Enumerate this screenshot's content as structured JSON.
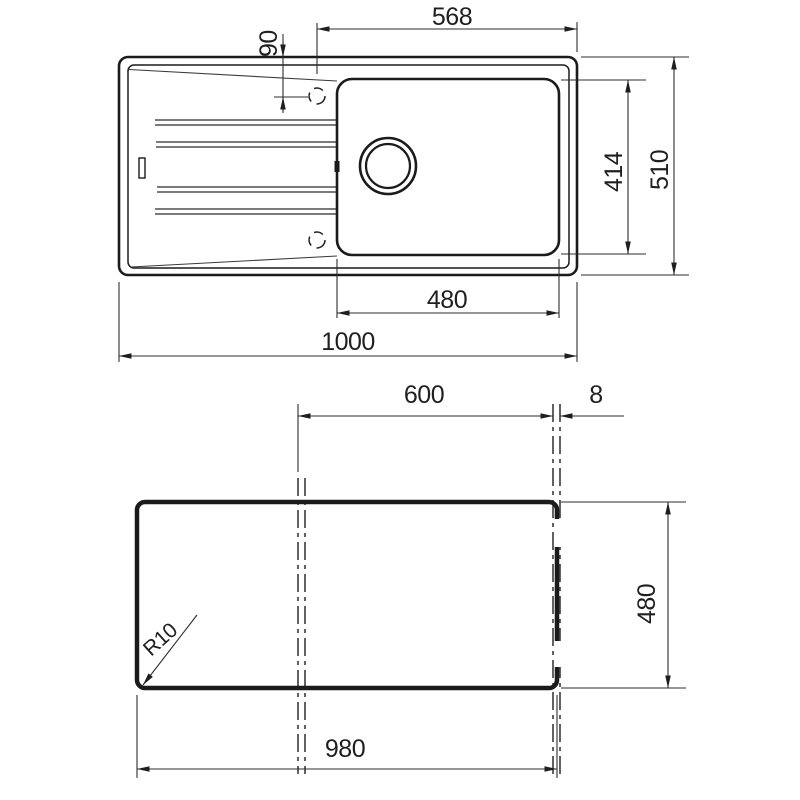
{
  "colors": {
    "background": "#ffffff",
    "line": "#1b1b1b",
    "dimension_line": "#2e2e2e",
    "text": "#1f1f1f"
  },
  "top_view": {
    "dims": {
      "tap_offset_h": "568",
      "tap_offset_v": "90",
      "overall_width": "510",
      "bowl_depth": "414",
      "bowl_width": "480",
      "overall_length": "1000"
    }
  },
  "cutout_view": {
    "dims": {
      "centerline_span": "600",
      "edge_gap": "8",
      "cutout_width": "480",
      "cutout_length": "980",
      "corner_radius": "R10"
    }
  }
}
